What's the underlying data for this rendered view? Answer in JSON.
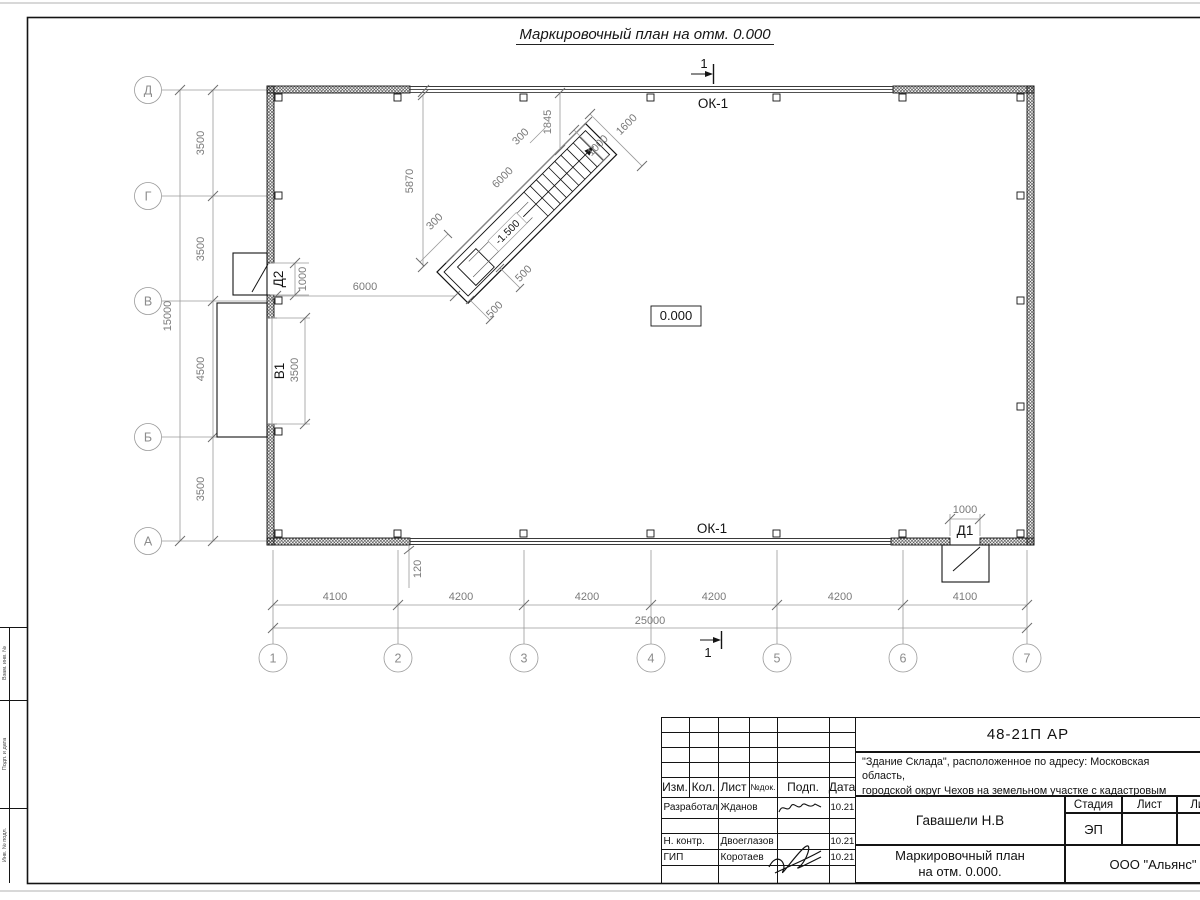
{
  "sheet": {
    "title": "Маркировочный план на отм. 0.000",
    "section_mark": "1"
  },
  "plan": {
    "axes_rows": [
      "Д",
      "Г",
      "В",
      "Б",
      "А"
    ],
    "axes_cols": [
      "1",
      "2",
      "3",
      "4",
      "5",
      "6",
      "7"
    ],
    "dims_left": [
      "3500",
      "3500",
      "4500",
      "3500"
    ],
    "dim_left_total": "15000",
    "dims_bottom": [
      "4100",
      "4200",
      "4200",
      "4200",
      "4200",
      "4100"
    ],
    "dim_bottom_total": "25000",
    "window_top": "ОК-1",
    "window_bottom": "ОК-1",
    "elevation": "0.000",
    "door1_label": "Д1",
    "door1_width": "1000",
    "door2_label": "Д2",
    "door2_width": "1000",
    "gate_label": "В1",
    "gate_width": "3500",
    "inner_dim_6000": "6000",
    "dim_120": "120",
    "stair": {
      "elevation": "-1.500",
      "dim_length": "6000",
      "dim_5870": "5870",
      "dim_1845": "1845",
      "dim_1600": "1600",
      "dim_1000": "1000",
      "dim_300_lower": "300",
      "dim_300_upper": "300",
      "dim_500_a": "500",
      "dim_500_b": "500"
    }
  },
  "titleblock": {
    "doc_code": "48-21П АР",
    "desc_line1": "\"Здание Склада\", расположенное по адресу: Московская область,",
    "desc_line2": "городской округ Чехов на земельном участке с кадастровым",
    "desc_line3_prefix": "номером ",
    "cadastral_number": "50:31:0060205:252",
    "rev_headers": [
      "Изм.",
      "Кол.",
      "Лист",
      "№док.",
      "Подп.",
      "Дата"
    ],
    "signers": [
      {
        "role": "Разработал",
        "name": "Жданов",
        "date": "10.21"
      },
      {
        "role": "Н. контр.",
        "name": "Двоеглазов",
        "date": "10.21"
      },
      {
        "role": "ГИП",
        "name": "Коротаев",
        "date": "10.21"
      }
    ],
    "approver": "Гавашели Н.В",
    "sheet_title_line1": "Маркировочный план",
    "sheet_title_line2": "на отм. 0.000.",
    "stage_label": "Стадия",
    "sheet_label": "Лист",
    "sheets_label": "Листов",
    "stage_value": "ЭП",
    "company": "ООО \"Альянс\""
  },
  "frame_labels": [
    "Взам. инв. №",
    "Подп. и дата",
    "Инв. № подл."
  ]
}
